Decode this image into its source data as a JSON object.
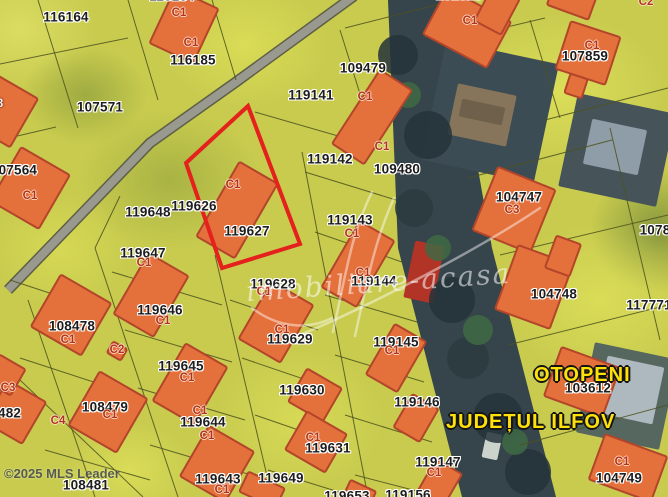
{
  "map": {
    "texts": {
      "otopeni": "OTOPENI",
      "county": "JUDEȚUL ILFOV",
      "copyright": "©2025 MLS Leader"
    },
    "watermark": {
      "text": "imobiliare-acasa"
    },
    "colors": {
      "building_fill": "#e4703c",
      "building_stroke": "#b2452a",
      "boundary": "#4d521f",
      "highlight": "#e4211c",
      "road_casing": "#5d5f46",
      "road_fill": "#9a998f",
      "street_fill": "#36444b"
    },
    "highlight": {
      "points": "248,106 186,163 222,268 300,244"
    },
    "street": {
      "points": "388,0 448,0 492,248 556,497 462,497 398,248"
    },
    "road": {
      "path": "M354,-4 L236,82 L150,143 L8,290"
    },
    "flourish": [
      "M333,332 C347,268 352,232 372,192",
      "M355,336 C369,272 376,238 394,198",
      "M300,335 C360,310 470,255 540,208",
      "M252,308 C278,328 308,330 332,318"
    ],
    "parcel_labels": [
      [
        "116184",
        172,
        -4
      ],
      [
        "116164",
        66,
        17
      ],
      [
        "116185",
        193,
        60
      ],
      [
        "101626",
        459,
        -5
      ],
      [
        "107571",
        100,
        107
      ],
      [
        "109479",
        363,
        68
      ],
      [
        "107859",
        585,
        56
      ],
      [
        "119141",
        311,
        95
      ],
      [
        "107564",
        14,
        170
      ],
      [
        "119142",
        330,
        159
      ],
      [
        "109480",
        397,
        169
      ],
      [
        "104747",
        519,
        197
      ],
      [
        "119626",
        194,
        206
      ],
      [
        "119648",
        148,
        212
      ],
      [
        "119143",
        350,
        220
      ],
      [
        "119627",
        247,
        231
      ],
      [
        "119647",
        143,
        253
      ],
      [
        "119628",
        273,
        284
      ],
      [
        "119144",
        374,
        281
      ],
      [
        "104748",
        554,
        294
      ],
      [
        "117771",
        649,
        305
      ],
      [
        "119646",
        160,
        310
      ],
      [
        "108478",
        72,
        326
      ],
      [
        "119629",
        290,
        339
      ],
      [
        "119145",
        396,
        342
      ],
      [
        "119645",
        181,
        366
      ],
      [
        "103612",
        588,
        388
      ],
      [
        "119630",
        302,
        390
      ],
      [
        "119146",
        417,
        402
      ],
      [
        "108479",
        105,
        407
      ],
      [
        "108482",
        -2,
        413
      ],
      [
        "119644",
        203,
        422
      ],
      [
        "119631",
        328,
        448
      ],
      [
        "119147",
        438,
        462
      ],
      [
        "104749",
        619,
        478
      ],
      [
        "119643",
        218,
        479
      ],
      [
        "119649",
        281,
        478
      ],
      [
        "108481",
        86,
        485
      ],
      [
        "1078",
        655,
        230
      ],
      [
        "119653",
        347,
        496
      ],
      [
        "119156",
        408,
        495
      ]
    ],
    "building_labels": [
      [
        "C1",
        179,
        13
      ],
      [
        "C1",
        191,
        43
      ],
      [
        "C1",
        470,
        21
      ],
      [
        "C2",
        646,
        2
      ],
      [
        "C1",
        592,
        46
      ],
      [
        "C1",
        365,
        97
      ],
      [
        "C1",
        382,
        147
      ],
      [
        "C1",
        30,
        196
      ],
      [
        "C1",
        233,
        185
      ],
      [
        "C3",
        512,
        210
      ],
      [
        "C1",
        144,
        263
      ],
      [
        "C1",
        163,
        321
      ],
      [
        "C1",
        68,
        340
      ],
      [
        "C2",
        117,
        350
      ],
      [
        "C1",
        187,
        378
      ],
      [
        "C3",
        8,
        388
      ],
      [
        "C1",
        200,
        411
      ],
      [
        "C4",
        58,
        421
      ],
      [
        "C1",
        110,
        415
      ],
      [
        "C1",
        207,
        436
      ],
      [
        "C1",
        264,
        292
      ],
      [
        "C1",
        282,
        330
      ],
      [
        "C1",
        352,
        234
      ],
      [
        "C1",
        363,
        273
      ],
      [
        "C1",
        392,
        351
      ],
      [
        "C1",
        313,
        438
      ],
      [
        "C1",
        434,
        473
      ],
      [
        "C1",
        622,
        462
      ],
      [
        "C1",
        222,
        490
      ],
      [
        "8",
        0,
        104,
        "white"
      ]
    ],
    "buildings": [
      [
        184,
        26,
        48,
        60,
        25
      ],
      [
        -2,
        108,
        60,
        56,
        30
      ],
      [
        30,
        188,
        56,
        62,
        30
      ],
      [
        237,
        210,
        44,
        86,
        30
      ],
      [
        372,
        117,
        38,
        88,
        33
      ],
      [
        467,
        28,
        72,
        52,
        28
      ],
      [
        497,
        10,
        30,
        40,
        28
      ],
      [
        572,
        0,
        44,
        26,
        20
      ],
      [
        588,
        53,
        52,
        50,
        18
      ],
      [
        576,
        86,
        18,
        20,
        18
      ],
      [
        514,
        210,
        62,
        68,
        22
      ],
      [
        151,
        295,
        46,
        70,
        30
      ],
      [
        71,
        315,
        58,
        60,
        30
      ],
      [
        117,
        351,
        16,
        13,
        30
      ],
      [
        190,
        384,
        48,
        66,
        30
      ],
      [
        108,
        412,
        55,
        62,
        30
      ],
      [
        15,
        412,
        44,
        48,
        30
      ],
      [
        5,
        375,
        30,
        30,
        30
      ],
      [
        217,
        464,
        52,
        58,
        30
      ],
      [
        276,
        322,
        48,
        66,
        30
      ],
      [
        315,
        395,
        40,
        38,
        30
      ],
      [
        316,
        442,
        46,
        44,
        30
      ],
      [
        358,
        264,
        40,
        76,
        30
      ],
      [
        396,
        358,
        36,
        58,
        30
      ],
      [
        416,
        418,
        30,
        38,
        30
      ],
      [
        439,
        484,
        30,
        40,
        30
      ],
      [
        534,
        287,
        58,
        68,
        20
      ],
      [
        563,
        256,
        26,
        34,
        20
      ],
      [
        582,
        382,
        62,
        52,
        20
      ],
      [
        628,
        468,
        66,
        48,
        20
      ],
      [
        262,
        490,
        40,
        22,
        25
      ],
      [
        360,
        493,
        28,
        16,
        25
      ]
    ],
    "photo_patches": [
      [
        490,
        112,
        115,
        122,
        12,
        "#3c4c54"
      ],
      [
        482,
        115,
        60,
        52,
        12,
        "#86755a"
      ],
      [
        482,
        112,
        44,
        18,
        12,
        "#6e604a"
      ],
      [
        617,
        150,
        100,
        95,
        12,
        "#46545a"
      ],
      [
        615,
        147,
        56,
        46,
        12,
        "#8e9da8"
      ],
      [
        627,
        396,
        85,
        92,
        12,
        "#56675f"
      ],
      [
        630,
        390,
        58,
        58,
        12,
        "#aeb9bf"
      ],
      [
        424,
        272,
        30,
        58,
        12,
        "#b23427"
      ],
      [
        492,
        446,
        16,
        26,
        12,
        "#ccd3cc"
      ]
    ],
    "trees": [
      [
        398,
        55,
        20,
        "#243339"
      ],
      [
        428,
        135,
        24,
        "#243339"
      ],
      [
        414,
        208,
        19,
        "#2a3b40"
      ],
      [
        452,
        300,
        23,
        "#243339"
      ],
      [
        468,
        358,
        21,
        "#2a3b40"
      ],
      [
        498,
        418,
        25,
        "#243339"
      ],
      [
        528,
        472,
        23,
        "#243339"
      ],
      [
        408,
        95,
        13,
        "#3f6a45"
      ],
      [
        438,
        248,
        13,
        "#3f6a45"
      ],
      [
        478,
        330,
        15,
        "#3f6a45"
      ],
      [
        515,
        442,
        13,
        "#3f6a45"
      ],
      [
        452,
        30,
        12,
        "#3f6a45"
      ]
    ],
    "lines": [
      [
        38,
        0,
        78,
        128
      ],
      [
        128,
        0,
        158,
        100
      ],
      [
        212,
        0,
        236,
        80
      ],
      [
        0,
        64,
        128,
        38
      ],
      [
        0,
        140,
        56,
        127
      ],
      [
        345,
        28,
        448,
        2
      ],
      [
        340,
        30,
        372,
        132
      ],
      [
        452,
        40,
        545,
        18
      ],
      [
        530,
        20,
        560,
        118
      ],
      [
        545,
        120,
        668,
        88
      ],
      [
        255,
        112,
        352,
        140
      ],
      [
        348,
        132,
        392,
        122
      ],
      [
        305,
        172,
        396,
        200
      ],
      [
        315,
        232,
        402,
        262
      ],
      [
        325,
        295,
        417,
        322
      ],
      [
        335,
        355,
        424,
        382
      ],
      [
        345,
        415,
        432,
        442
      ],
      [
        355,
        475,
        440,
        497
      ],
      [
        302,
        152,
        368,
        497
      ],
      [
        215,
        255,
        272,
        497
      ],
      [
        95,
        248,
        178,
        497
      ],
      [
        95,
        248,
        120,
        196
      ],
      [
        112,
        272,
        222,
        305
      ],
      [
        125,
        330,
        232,
        362
      ],
      [
        138,
        388,
        245,
        420
      ],
      [
        150,
        445,
        258,
        477
      ],
      [
        230,
        300,
        318,
        330
      ],
      [
        242,
        358,
        330,
        388
      ],
      [
        255,
        415,
        342,
        445
      ],
      [
        268,
        470,
        355,
        497
      ],
      [
        468,
        178,
        612,
        140
      ],
      [
        500,
        255,
        668,
        215
      ],
      [
        508,
        345,
        668,
        305
      ],
      [
        520,
        445,
        668,
        405
      ],
      [
        610,
        128,
        660,
        340
      ],
      [
        0,
        361,
        143,
        497
      ],
      [
        28,
        300,
        95,
        497
      ],
      [
        20,
        358,
        118,
        390
      ],
      [
        45,
        450,
        150,
        480
      ],
      [
        10,
        280,
        95,
        308
      ]
    ]
  }
}
